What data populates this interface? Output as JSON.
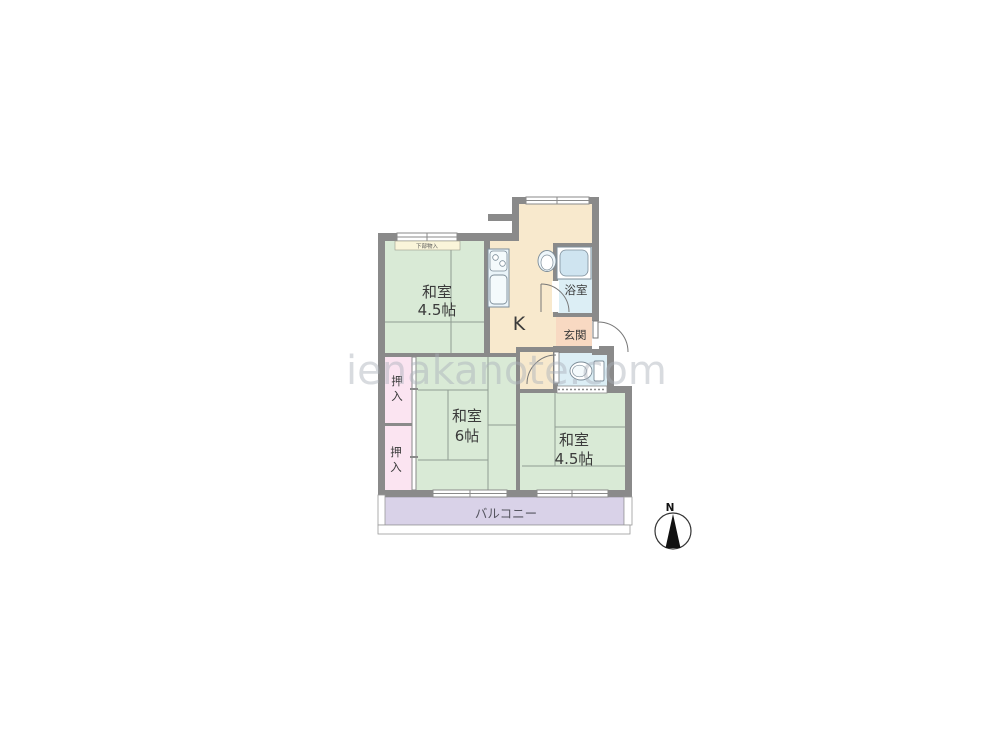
{
  "floorplan": {
    "watermark": {
      "text": "ienakanote.com"
    },
    "compass": {
      "label": "N"
    },
    "rooms": {
      "washitsu_top_left": {
        "name": "和室",
        "size": "4.5帖"
      },
      "kitchen": {
        "label": "K"
      },
      "bathroom": {
        "label": "浴室"
      },
      "entrance": {
        "label": "玄関"
      },
      "closet_upper": {
        "char1": "押",
        "char2": "入"
      },
      "closet_lower": {
        "char1": "押",
        "char2": "入"
      },
      "washitsu_center": {
        "name": "和室",
        "size": "6帖"
      },
      "washitsu_bottom_right": {
        "name": "和室",
        "size": "4.5帖"
      },
      "balcony": {
        "label": "バルコニー"
      },
      "under_window_storage": {
        "label": "下部物入"
      }
    },
    "colors": {
      "wall": "#8a8a8a",
      "tatami_green": "#d9ead6",
      "kitchen_beige": "#f8e9cd",
      "water_blue": "#dceef5",
      "entrance_salmon": "#f8d9c2",
      "closet_pink": "#fbe4f1",
      "balcony_purple": "#d9d2e8",
      "storage_cream": "#faf5da",
      "fixture_blue": "#eaf4f9"
    }
  }
}
